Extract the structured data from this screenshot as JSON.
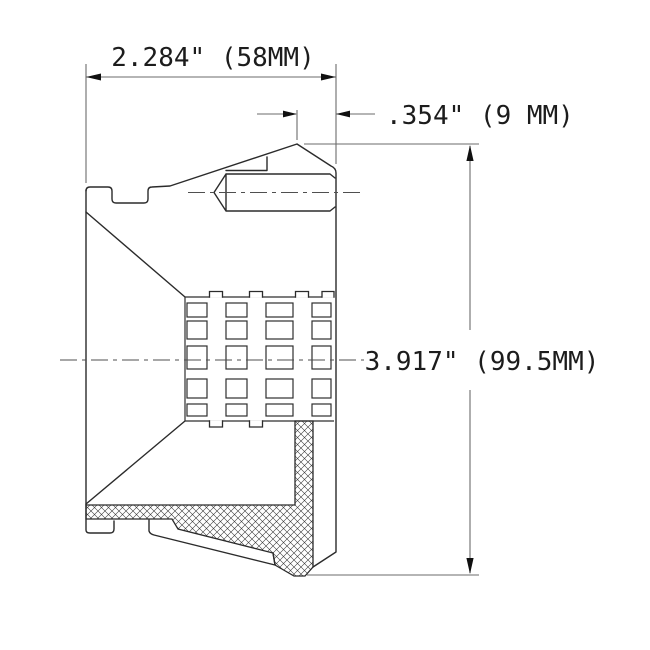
{
  "drawing": {
    "title": "Part cross-section technical drawing",
    "dimensions": {
      "width_label": "2.284\" (58MM)",
      "offset_label": ".354\" (9 MM)",
      "height_label": "3.917\" (99.5MM)"
    },
    "colors": {
      "line": "#2b2b2b",
      "dimension_line": "#6b6b6b",
      "text": "#1c1c1c",
      "background": "#ffffff"
    }
  }
}
